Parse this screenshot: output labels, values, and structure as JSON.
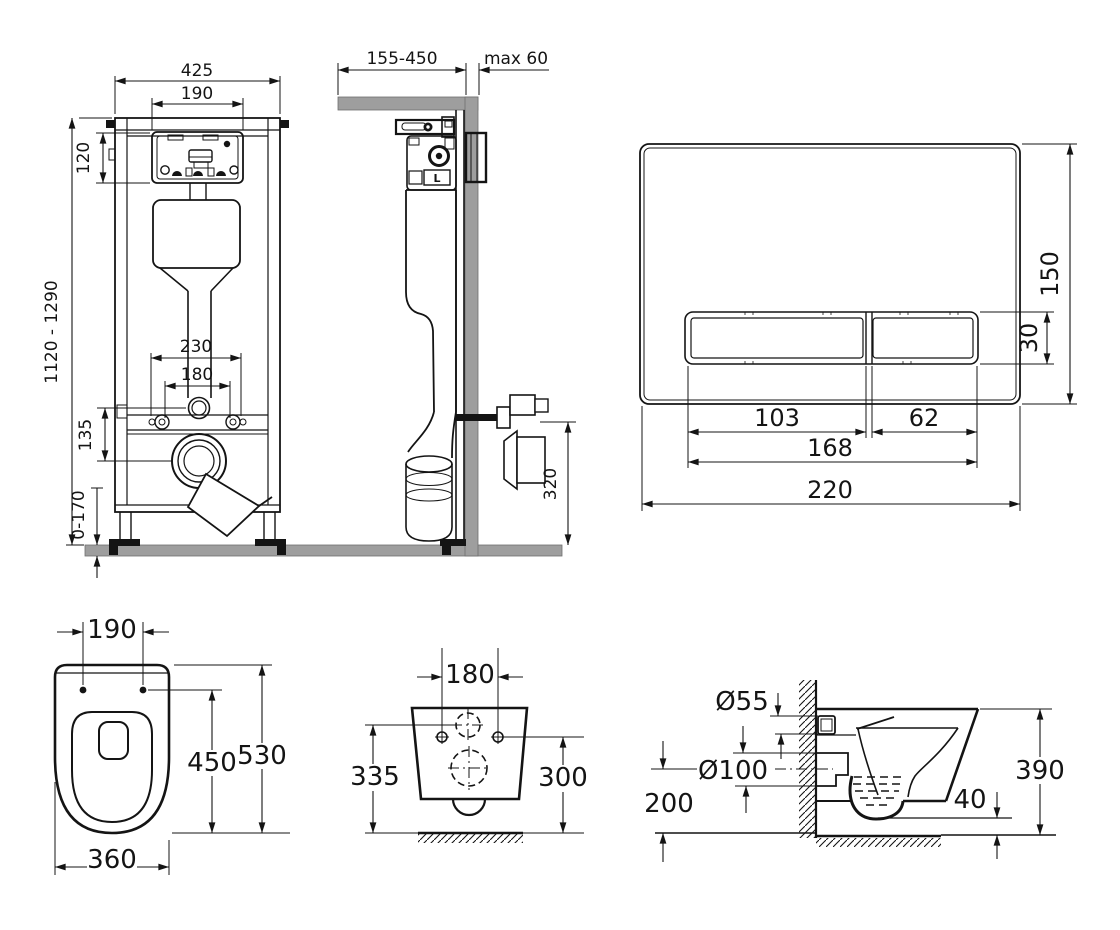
{
  "drawing_title": "wall-hung toilet installation set technical drawing",
  "colors": {
    "line": "#141414",
    "masonry": "#9e9e9e"
  },
  "views": {
    "frame_front": {
      "dims": {
        "overall_width": "425",
        "opening_width": "190",
        "opening_height": "120",
        "height_range": "1120 - 1290",
        "fixing_outer": "230",
        "fixing_inner": "180",
        "outlet_offset": "135",
        "foot_adjust": "0-170"
      }
    },
    "frame_side": {
      "dims": {
        "depth_range": "155-450",
        "finish_max": "max 60",
        "connection_height": "320"
      },
      "labels": {
        "valve_mark": "L"
      }
    },
    "flush_plate": {
      "dims": {
        "height": "150",
        "button_height": "30",
        "button_large_width": "103",
        "button_small_width": "62",
        "buttons_width": "168",
        "width": "220"
      }
    },
    "bowl_top": {
      "dims": {
        "fixing_width": "190",
        "inner_depth": "450",
        "depth": "530",
        "width": "360"
      }
    },
    "bowl_rear": {
      "dims": {
        "fixing_width": "180",
        "height_left": "335",
        "height_right": "300"
      }
    },
    "bowl_side": {
      "dims": {
        "inlet_diameter": "Ø55",
        "outlet_diameter": "Ø100",
        "outlet_axis_height": "200",
        "bottom_gap": "40",
        "height": "390"
      }
    }
  }
}
